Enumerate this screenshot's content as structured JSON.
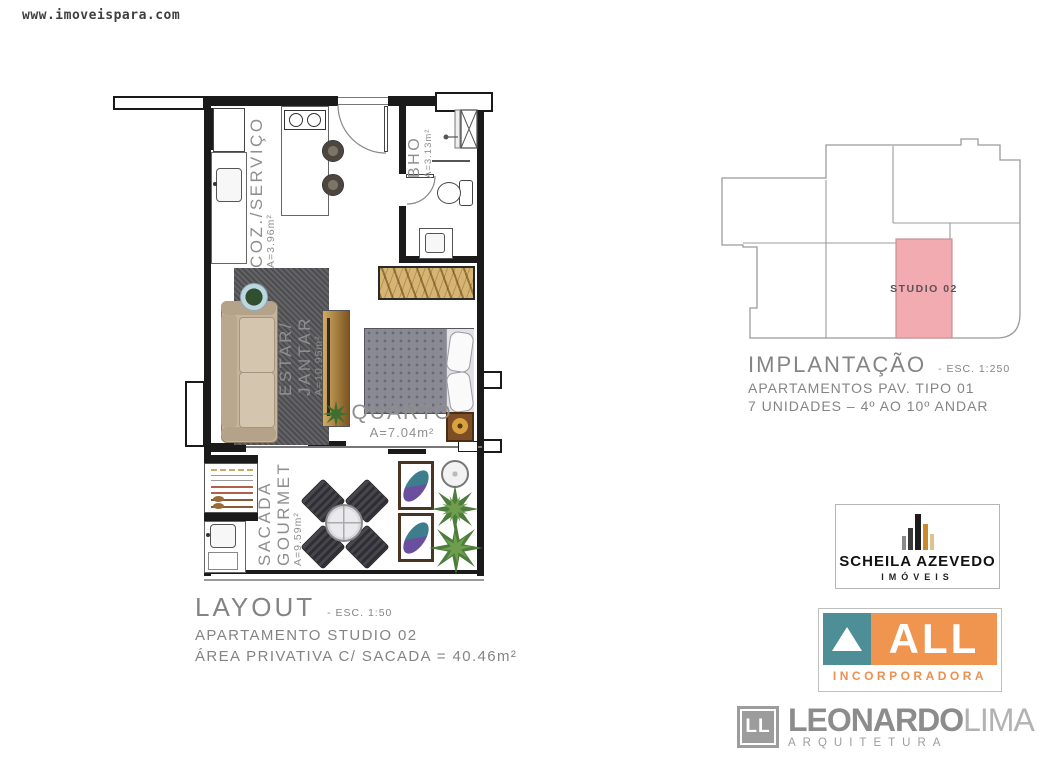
{
  "watermark": "www.imoveispara.com",
  "plan": {
    "rooms": {
      "coz": {
        "label": "COZ./SERVIÇO",
        "area": "A=3.96m²"
      },
      "bho": {
        "label": "BHO",
        "area": "A=3.13m²"
      },
      "estar": {
        "line1": "ESTAR/",
        "line2": "JANTAR",
        "area": "A=10.95m²"
      },
      "quarto": {
        "label": "QUARTO",
        "area": "A=7.04m²"
      },
      "sacada": {
        "line1": "SACADA",
        "line2": "GOURMET",
        "area": "A=9.59m²"
      }
    },
    "caption": {
      "title": "LAYOUT",
      "scale": "- ESC. 1:50",
      "line2": "APARTAMENTO STUDIO 02",
      "line3": "ÁREA PRIVATIVA C/ SACADA = 40.46m²"
    }
  },
  "implantation": {
    "unit_label": "STUDIO 02",
    "unit_fill": "#f2abb1",
    "caption": {
      "title": "IMPLANTAÇÃO",
      "scale": "- ESC. 1:250",
      "line2": "APARTAMENTOS PAV. TIPO 01",
      "line3": "7 UNIDADES – 4º AO 10º ANDAR"
    }
  },
  "logos": {
    "scheila": {
      "name": "SCHEILA AZEVEDO",
      "sub": "IMÓVEIS"
    },
    "all": {
      "name": "ALL",
      "sub": "INCORPORADORA",
      "teal": "#4e8e96",
      "orange": "#f0954f"
    },
    "leonardo": {
      "icon": "LL",
      "bold": "LEONARDO",
      "light": "LIMA",
      "sub": "ARQUITETURA"
    }
  }
}
